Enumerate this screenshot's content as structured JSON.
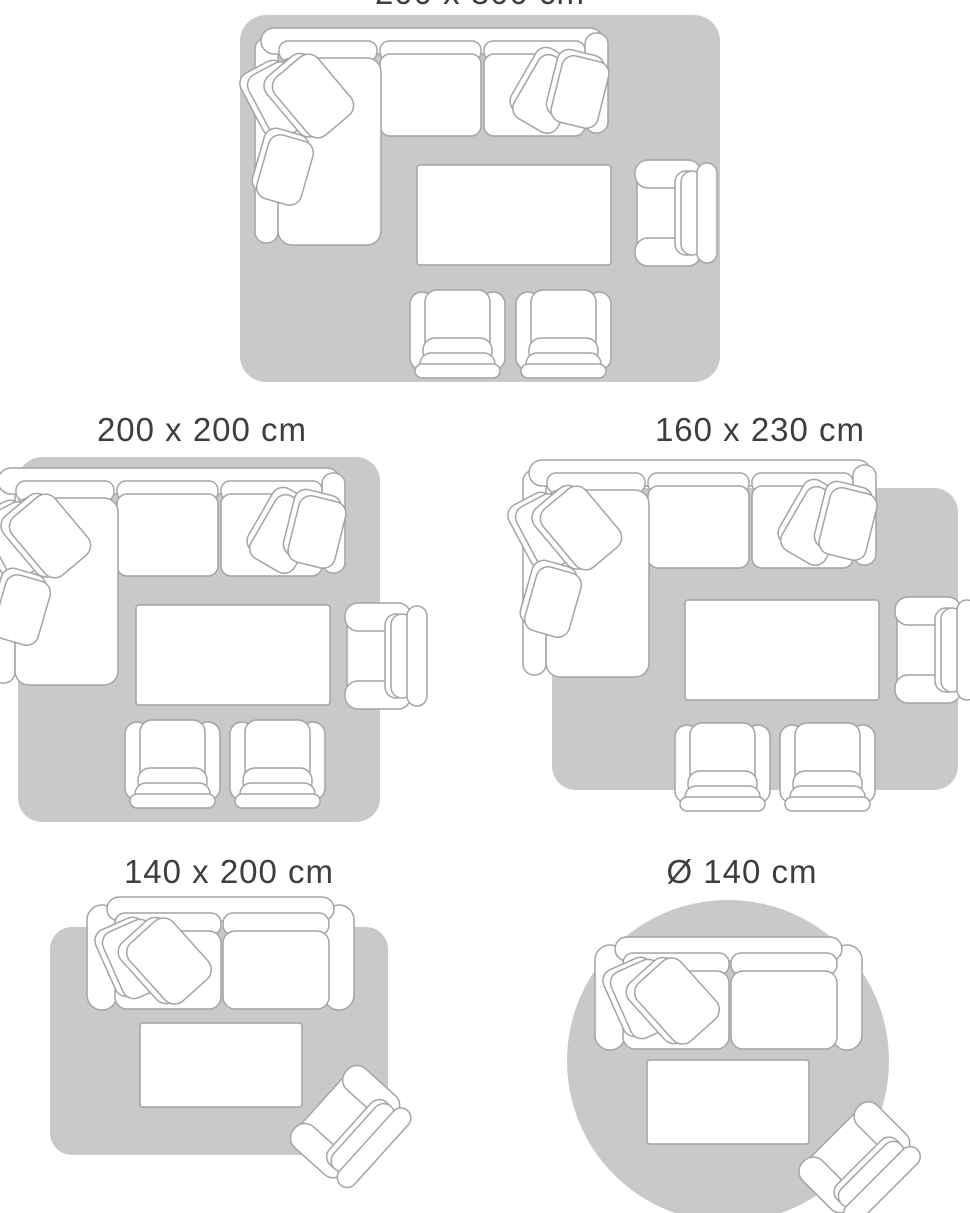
{
  "title": "Rug size guide with living room furniture layouts",
  "colors": {
    "background": "#ffffff",
    "rug": "#c9c9c9",
    "furniture_fill": "#ffffff",
    "furniture_stroke": "#a4a4a4",
    "label_text": "#3e3e3e"
  },
  "panels": [
    {
      "id": "rug-200x300",
      "label": "200 x 300 cm",
      "shape": "rectangle",
      "furniture": [
        "corner-sofa",
        "coffee-table",
        "armchair",
        "club-chair",
        "club-chair"
      ],
      "note": "label clipped at top edge of screenshot"
    },
    {
      "id": "rug-200x200",
      "label": "200 x 200 cm",
      "shape": "rectangle",
      "furniture": [
        "corner-sofa",
        "coffee-table",
        "armchair",
        "club-chair",
        "club-chair"
      ]
    },
    {
      "id": "rug-160x230",
      "label": "160 x 230 cm",
      "shape": "rectangle",
      "furniture": [
        "corner-sofa",
        "coffee-table",
        "armchair",
        "club-chair",
        "club-chair"
      ]
    },
    {
      "id": "rug-140x200",
      "label": "140 x 200 cm",
      "shape": "rectangle",
      "furniture": [
        "loveseat-sofa",
        "coffee-table",
        "armchair"
      ]
    },
    {
      "id": "rug-140-round",
      "label": "Ø 140 cm",
      "shape": "circle",
      "furniture": [
        "loveseat-sofa",
        "coffee-table",
        "armchair"
      ]
    }
  ]
}
